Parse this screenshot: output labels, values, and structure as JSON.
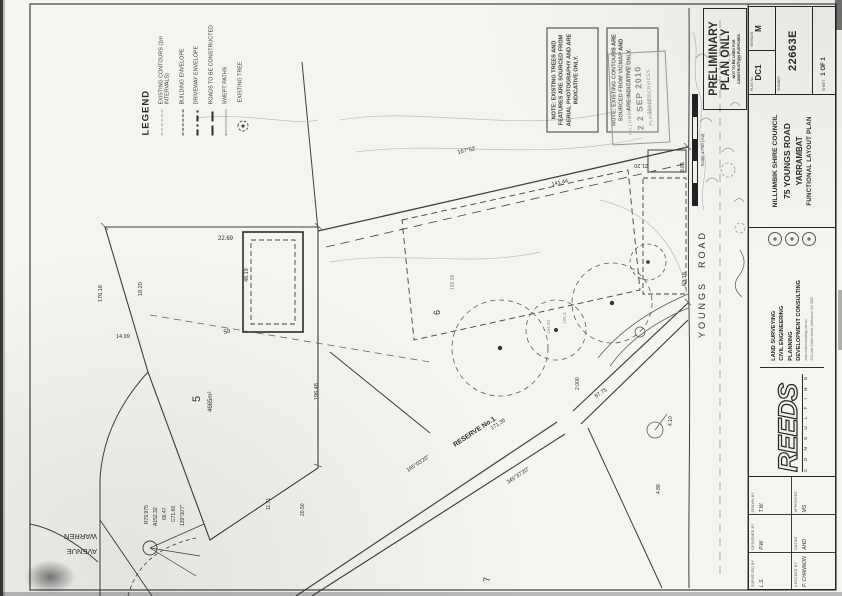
{
  "sheet": {
    "legend": {
      "title": "LEGEND",
      "items": [
        {
          "label": "EXISTING CONTOURS (1m INTERVALS)"
        },
        {
          "label": "BUILDING ENVELOPE"
        },
        {
          "label": "DRIVEWAY ENVELOPE"
        },
        {
          "label": "ROADS TO BE CONSTRUCTED"
        },
        {
          "label": "SWEPT PATHS"
        },
        {
          "label": "EXISTING TREE"
        }
      ]
    },
    "notes": {
      "note1": "NOTE: EXISTING TREES AND FEATURES ARE SOURCED FROM AERIAL PHOTOGRAPHY AND ARE INDICATIVE ONLY.",
      "note2": "NOTE: EXISTING CONTOURS ARE SOURCED FROM VICMAP AND ARE INDICATIVE ONLY."
    },
    "received_stamp": {
      "org": "NILLUMBIK SHIRE COUNCIL",
      "date": "2 2 SEP 2010",
      "dept": "PLANNING SERVICES"
    },
    "preliminary_stamp": {
      "line1": "PRELIMINARY",
      "line2": "PLAN ONLY",
      "sub1": "NOT TO BE USED FOR",
      "sub2": "CONSTRUCTION PURPOSES"
    },
    "scale_bar": {
      "label": "Scale 1:750 (A3)"
    },
    "title_block": {
      "client": {
        "l1": "NILLUMBIK SHIRE COUNCIL",
        "l2": "75 YOUNGS ROAD",
        "l3": "YARRAMBAT",
        "l4": "FUNCTIONAL LAYOUT PLAN"
      },
      "firm": {
        "name": "REEDS",
        "tagline": "C O N S U L T I N G",
        "services": [
          "LAND SURVEYING",
          "CIVIL ENGINEERING",
          "PLANNING",
          "DEVELOPMENT CONSULTING"
        ],
        "web": "www.reedsconsulting.com.au",
        "address": "433 Little Collins Street, Melbourne VIC 3000"
      },
      "fields": [
        {
          "label": "SURVEYED BY",
          "value": "L.S."
        },
        {
          "label": "DESIGNED BY",
          "value": "P.W."
        },
        {
          "label": "DRAWN BY",
          "value": "T.W."
        },
        {
          "label": "CHECKED BY",
          "value": "P. CHANNON"
        },
        {
          "label": "DATUM",
          "value": "AHD"
        },
        {
          "label": "APPROVED",
          "value": "MS"
        }
      ],
      "plan_no_label": "PLAN No.",
      "plan_no": "DC1",
      "version_label": "VERSION",
      "version": "M",
      "number_label": "NUMBER",
      "number": "22663E",
      "sheet_label": "SHEET",
      "sheet_value": "1 OF 1"
    },
    "plan_labels": [
      {
        "t": "YOUNGS"
      },
      {
        "t": "ROAD"
      },
      {
        "t": "WARREN"
      },
      {
        "t": "AVENUE"
      },
      {
        "t": "RESERVE No.1"
      },
      {
        "t": "165°03'20\""
      },
      {
        "t": "171.35"
      },
      {
        "t": "345°37'20\""
      },
      {
        "t": "87.75"
      },
      {
        "t": "5"
      },
      {
        "t": "4665m²"
      },
      {
        "t": "6"
      },
      {
        "t": "7"
      },
      {
        "t": "22.69"
      },
      {
        "t": "18.20"
      },
      {
        "t": "48.19"
      },
      {
        "t": "50"
      },
      {
        "t": "14.99"
      },
      {
        "t": "141.44"
      },
      {
        "t": "167°52'"
      },
      {
        "t": "63.18"
      },
      {
        "t": "4.10"
      },
      {
        "t": "4.88"
      },
      {
        "t": "21.20"
      },
      {
        "t": "9.85"
      },
      {
        "t": "R79.975"
      },
      {
        "t": "A152.32"
      },
      {
        "t": "66.47"
      },
      {
        "t": "C71.66"
      },
      {
        "t": "139°30'7\""
      },
      {
        "t": "11.71"
      },
      {
        "t": "20.50"
      },
      {
        "t": "194.075"
      },
      {
        "t": "198.98"
      },
      {
        "t": "2.000"
      },
      {
        "t": "196.48"
      },
      {
        "t": "176.18"
      },
      {
        "t": "194.50"
      },
      {
        "t": "195.3"
      }
    ]
  }
}
